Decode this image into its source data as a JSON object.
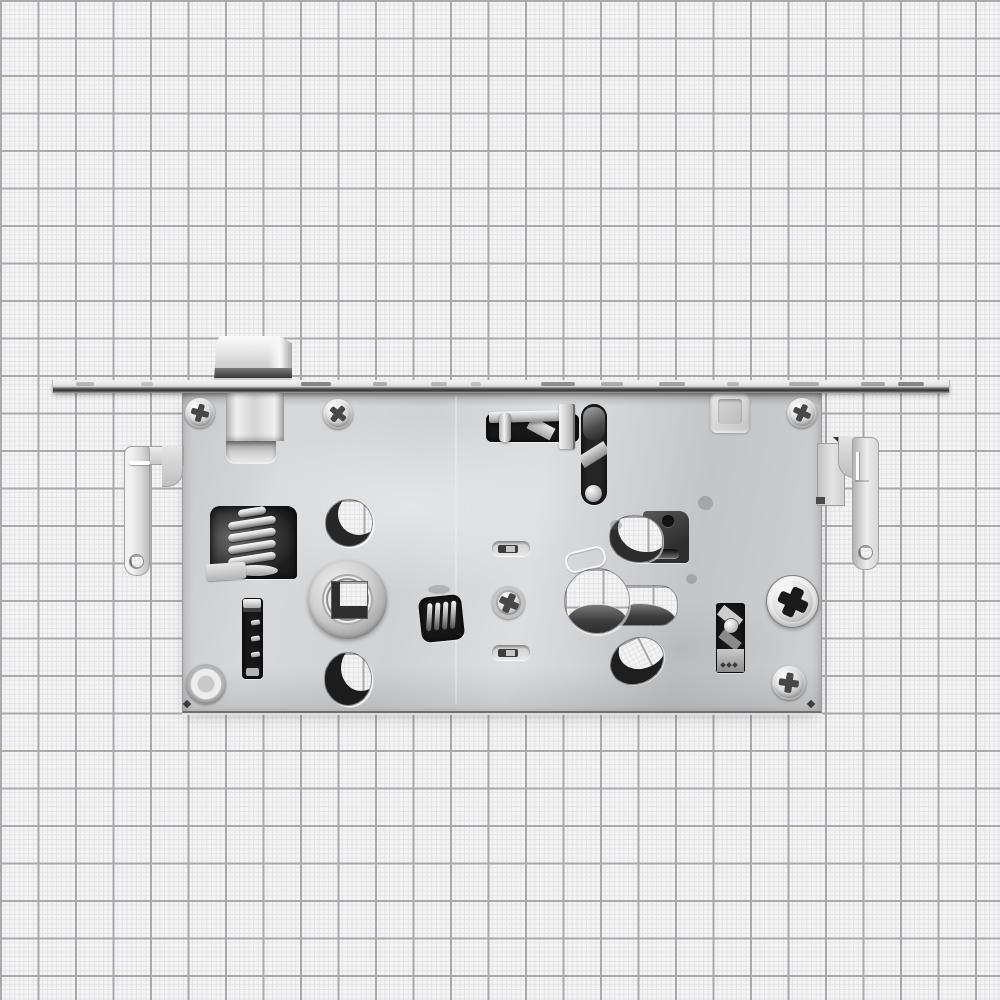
{
  "scene": {
    "type": "product-photo",
    "subject": "Mortise door lock case (internal mechanism side view) in galvanized steel",
    "background": "graph paper grid, no text or labels visible"
  },
  "palette": {
    "paper": "#f4f4f5",
    "grid_fine": "#e3e3e5",
    "grid_major": "#a9a9ab",
    "steel_bright": "#f2f2f2",
    "steel_light": "#dcdee0",
    "steel_mid": "#cfd1d3",
    "steel_shade": "#a5a5a5",
    "steel_edge": "#8f8f8f",
    "opening_dark": "#181818",
    "plate_dark": "#3f3f3f"
  },
  "grid": {
    "major_cell_px": 37.5,
    "fine_cell_px": 4.7
  },
  "parts": [
    {
      "name": "faceplate",
      "note": "long forend strip seen edge-on across the image"
    },
    {
      "name": "latch-bolt",
      "note": "bevelled spring latch protruding above the faceplate"
    },
    {
      "name": "lock-case",
      "note": "rectangular steel case body"
    },
    {
      "name": "latch-guide-channel",
      "note": "raised channel under the latch"
    },
    {
      "name": "top-screws",
      "note": "three phillips screws along the top edge"
    },
    {
      "name": "embossed-square",
      "note": "pressed square boss near top right"
    },
    {
      "name": "left-mounting-bracket",
      "note": "hook-shaped bracket arm with hole, left side"
    },
    {
      "name": "right-mounting-bracket",
      "note": "hook-shaped bracket arm with hole, right side"
    },
    {
      "name": "compression-spring-window",
      "note": "dark window with coil spring, left"
    },
    {
      "name": "slider-rack",
      "note": "narrow vertical slot with notched slider"
    },
    {
      "name": "upper-round-hole",
      "note": "through-hole showing grid paper"
    },
    {
      "name": "handle-follower-hub",
      "note": "round hub with square spindle hole"
    },
    {
      "name": "lower-round-hole",
      "note": "through-hole showing grid paper"
    },
    {
      "name": "torsion-spring-window",
      "note": "small dark window with coil, center"
    },
    {
      "name": "lever-slot-horizontal",
      "note": "dark slot with flat metal bar and pin, top center"
    },
    {
      "name": "lever-slot-vertical",
      "note": "dark capsule slot with pin at bottom"
    },
    {
      "name": "stop-plate-cutout",
      "note": "opening with dark plate and round hole, center right"
    },
    {
      "name": "center-screw",
      "note": "phillips screw with washer, center"
    },
    {
      "name": "embossed-slots",
      "note": "two small stadium embossments"
    },
    {
      "name": "euro-cylinder-cutout",
      "note": "keyhole-profile through-hole, circle plus extension"
    },
    {
      "name": "oval-cutout",
      "note": "tilted oval through-hole below cylinder hole"
    },
    {
      "name": "deadbolt-guide-slot",
      "note": "vertical slot with pin and bolt tail, right"
    },
    {
      "name": "cam-disc",
      "note": "bright disc with dark cross slot, right"
    },
    {
      "name": "bottom-fasteners",
      "note": "rivet bottom left, phillips screw bottom right"
    }
  ]
}
